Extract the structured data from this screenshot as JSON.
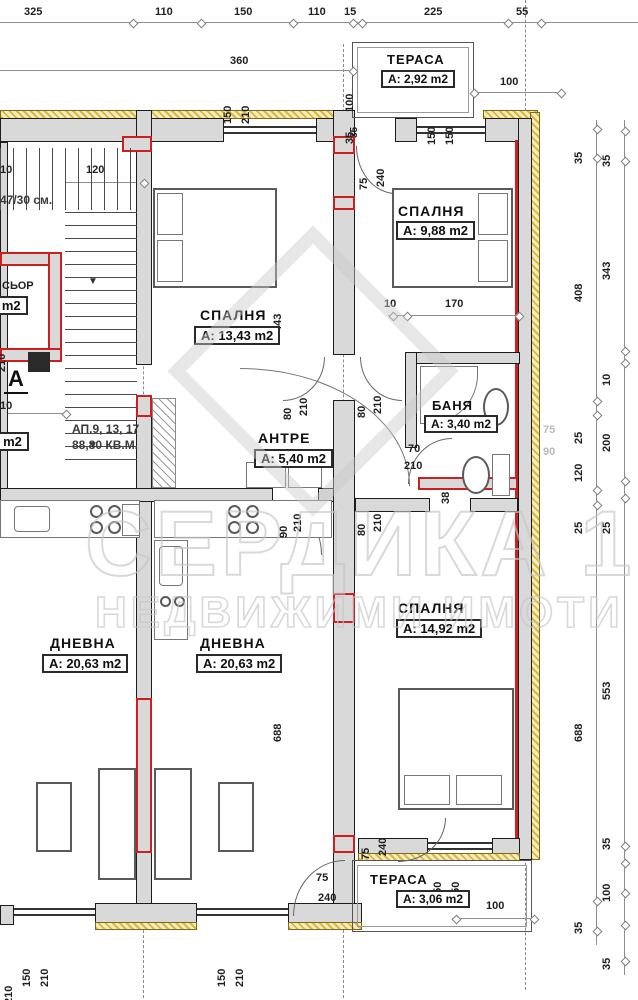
{
  "watermark": {
    "line1": "СЕРДИКА 1",
    "line2": "НЕДВИЖИМИ ИМОТИ"
  },
  "rooms": {
    "terrace_top": {
      "name": "ТЕРАСА",
      "area": "А: 2,92 m2"
    },
    "bedroom_tr": {
      "name": "СПАЛНЯ",
      "area": "А: 9,88 m2"
    },
    "bedroom_tl": {
      "name": "СПАЛНЯ",
      "area": "А: 13,43 m2"
    },
    "hall": {
      "name": "АНТРЕ",
      "area": "А: 5,40 m2"
    },
    "bath": {
      "name": "БАНЯ",
      "area": "А: 3,40 m2"
    },
    "living_left": {
      "name": "ДНЕВНА",
      "area": "А: 20,63 m2"
    },
    "living_right": {
      "name": "ДНЕВНА",
      "area": "А: 20,63 m2"
    },
    "bedroom_b": {
      "name": "СПАЛНЯ",
      "area": "А: 14,92 m2"
    },
    "terrace_b": {
      "name": "ТЕРАСА",
      "area": "А: 3,06 m2"
    }
  },
  "notes": {
    "apartments": "АП.9, 13, 17",
    "total_area": "88,80 КВ.М.",
    "stair_step": "47/30 см.",
    "section_letter": "А",
    "elevator_fragment": "СЬОР",
    "elevator_area_fragment": "4 m2",
    "corridor_area_fragment": "02 m2",
    "arrow_down": "▼"
  },
  "dims": {
    "top_row": [
      "325",
      "110",
      "150",
      "110",
      "15",
      "225",
      "55"
    ],
    "d360": "360",
    "d100": "100",
    "d120": "120",
    "d10": "10",
    "d170": "170",
    "d443": "443",
    "d688": "688",
    "d230": "230",
    "d210": "210",
    "d38": "38",
    "d35": "35",
    "pair_150_210": [
      "150",
      "210"
    ],
    "pair_150_150": [
      "150",
      "150"
    ],
    "pair_75_240": [
      "75",
      "240"
    ],
    "pair_80_210": [
      "80",
      "210"
    ],
    "pair_90_210": [
      "90",
      "210"
    ],
    "pair_70_210": [
      "70",
      "210"
    ],
    "pair_75_90": [
      "75",
      "90"
    ],
    "right_inner": [
      "35",
      "408",
      "25",
      "120",
      "25",
      "688",
      "35"
    ],
    "right_outer": [
      "35",
      "343",
      "10",
      "200",
      "25",
      "553",
      "35",
      "100",
      "35"
    ]
  }
}
